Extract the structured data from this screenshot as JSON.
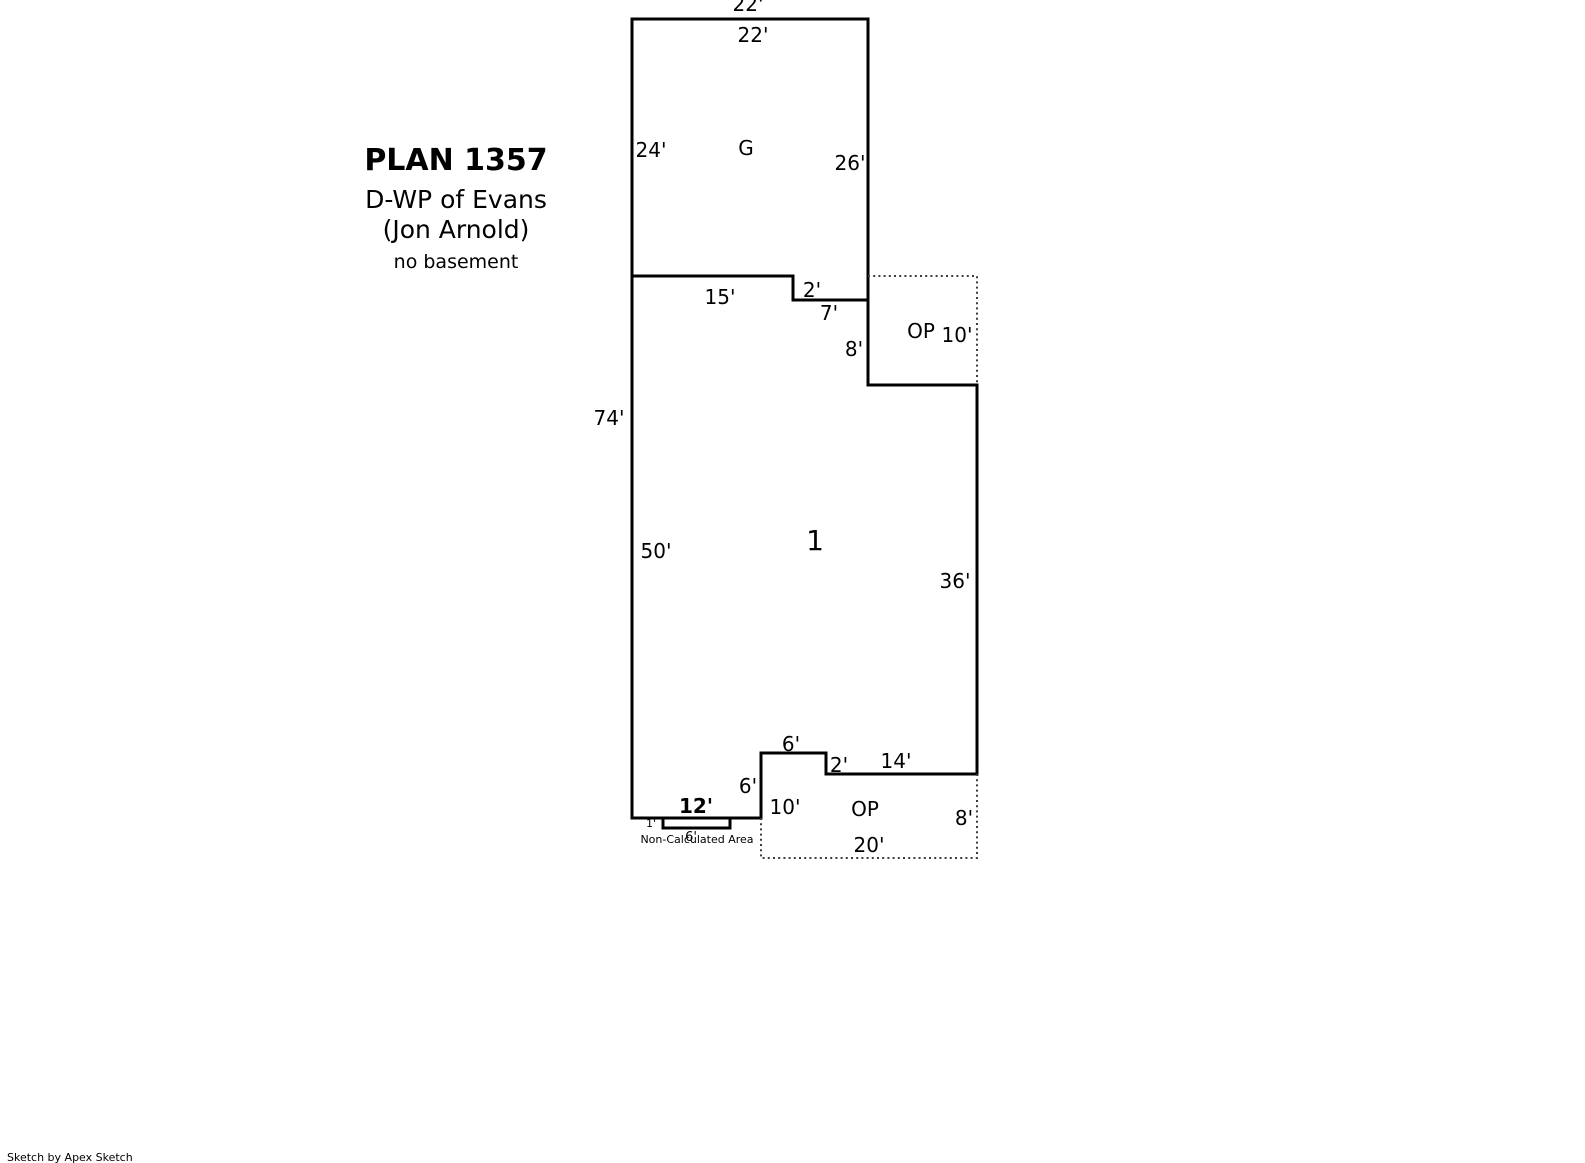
{
  "title_block": {
    "plan_number": "PLAN 1357",
    "description": "D-WP of Evans",
    "client": "(Jon Arnold)",
    "note": "no basement"
  },
  "footer": {
    "credit": "Sketch by Apex Sketch"
  },
  "colors": {
    "wall": "#000000",
    "porch_dotted": "#3d3d3d",
    "text": "#000000",
    "background": "#ffffff"
  },
  "areas": {
    "garage": {
      "label": "G",
      "dims": {
        "top_outside": "22'",
        "top_inside": "22'",
        "left": "24'",
        "right": "26'"
      }
    },
    "main_area": {
      "label": "1",
      "dims": {
        "overall_left": "74'",
        "left": "50'",
        "top": "15'",
        "top_step_down": "2'",
        "top_step_right": "7'",
        "upper_right": "8'",
        "right": "36'",
        "bottom_step_top": "6'",
        "bottom_step_down": "2'",
        "bottom_right": "14'",
        "bottom_step_left": "6'",
        "bottom": "12'"
      }
    },
    "open_porch_upper": {
      "label": "OP",
      "dims": {
        "right": "10'"
      }
    },
    "open_porch_lower": {
      "label": "OP",
      "dims": {
        "left": "10'",
        "right": "8'",
        "bottom": "20'"
      }
    },
    "non_calculated_area": {
      "label": "Non-Calculated Area",
      "dims": {
        "width": "6'",
        "height": "1'"
      }
    }
  }
}
